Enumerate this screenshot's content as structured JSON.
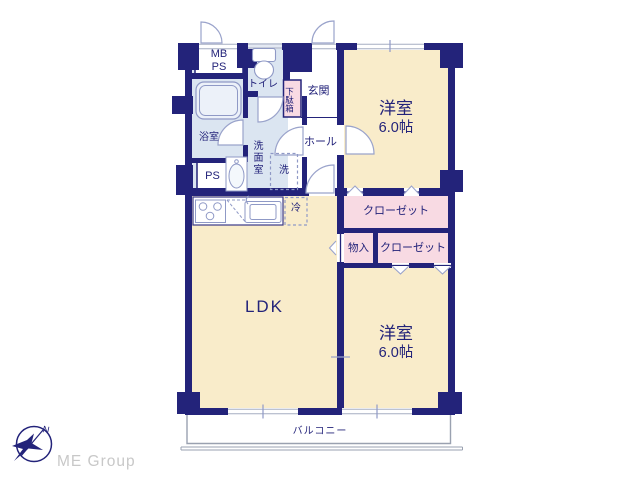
{
  "rooms": {
    "mbps": "MB\nPS",
    "toilet": "トイレ",
    "shoe_cabinet": "下駄箱",
    "entrance": "玄関",
    "bedroom1": {
      "name": "洋室",
      "size": "6.0帖"
    },
    "bathroom": "浴室",
    "washroom": "洗面室",
    "washer": "洗",
    "hall": "ホール",
    "pipe_space": "PS",
    "fridge": "冷",
    "closet1": "クローゼット",
    "storage": "物入",
    "closet2": "クローゼット",
    "ldk": "LDK",
    "bedroom2": {
      "name": "洋室",
      "size": "6.0帖"
    },
    "balcony": "バルコニー"
  },
  "compass": {
    "north": "N"
  },
  "logo": {
    "text": "ME Group"
  },
  "colors": {
    "wall_navy": "#23237a",
    "room_cream": "#f9ecca",
    "room_pink": "#f8dae3",
    "room_blue": "#dbe5f1",
    "fixture_stroke": "#8f99c6",
    "balcony_gray": "#9aa1b0",
    "logo_gray": "#c8c8c8"
  }
}
